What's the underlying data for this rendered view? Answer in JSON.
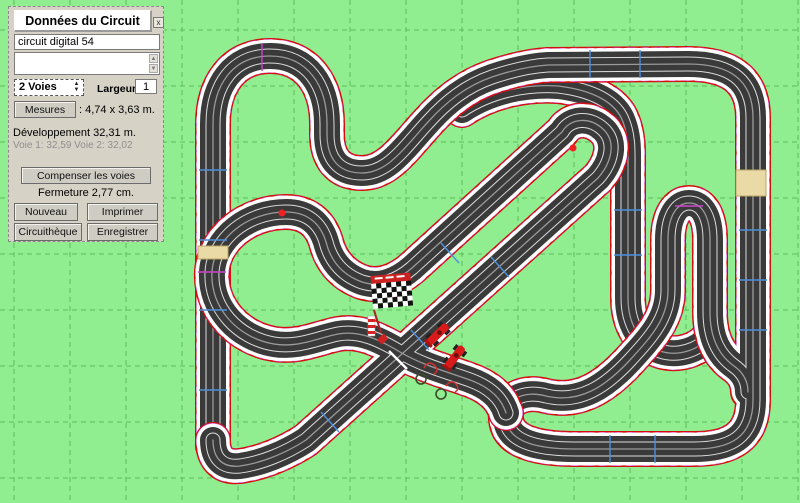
{
  "window": {
    "title": "Données du Circuit",
    "close_label": "x"
  },
  "panel": {
    "circuit_name": "circuit digital 54",
    "notes_value": "",
    "lanes_value": "2 Voies",
    "spinner_up_icon": "▲",
    "spinner_down_icon": "▼",
    "width_label": "Largeur",
    "width_value": "1",
    "measures_button": "Mesures",
    "measures_value": ": 4,74 x 3,63 m.",
    "development_line": "Développement 32,31 m.",
    "lane_lengths_line": "Voie 1: 32,59  Voie 2: 32,02",
    "compensate_button": "Compenser les voies",
    "closure_line": "Fermeture 2,77 cm.",
    "new_button": "Nouveau",
    "print_button": "Imprimer",
    "library_button": "Circuithèque",
    "save_button": "Enregistrer"
  },
  "track": {
    "description": "2-lane digital slot car circuit on green gridded workspace",
    "marker_icons": [
      "finish-flag",
      "start-line",
      "slot-car",
      "slot-car"
    ]
  },
  "colors": {
    "background": "#90ee90",
    "grid_line": "#5bbf5b",
    "curb_red": "#d60d0d",
    "curb_white": "#ffffff",
    "curve_accent": "#cc44cc",
    "road": "#3a3a3a",
    "lane_band": "#dcdcdc",
    "lane_center": "#9a9a9a",
    "joint_tick": "#4d8fe0",
    "special_piece": "#eadaa6",
    "panel_bg": "#d6d2c6",
    "flag_red": "#cc2222",
    "car_red": "#d81a1a"
  }
}
